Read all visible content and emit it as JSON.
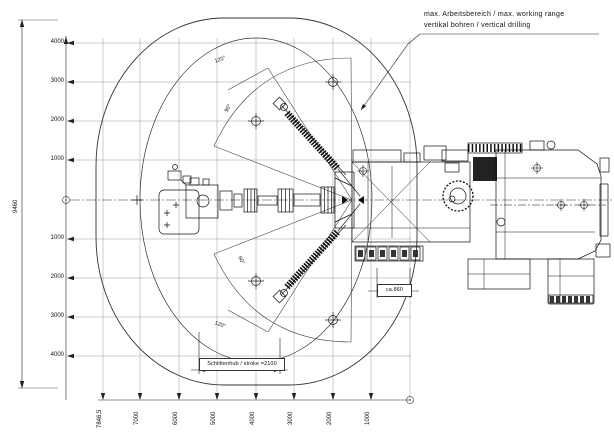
{
  "annotation": {
    "line1": "max. Arbeitsbereich / max. working range",
    "line2": "vertikal bohren / vertical drilling"
  },
  "dimensions": {
    "stroke": "Schlittenhub / stroke =2100",
    "offset": "ca.860",
    "overall_height": "9460"
  },
  "angles": {
    "top": "120°",
    "upper": "90°",
    "lower": "60°",
    "bottom": "120°"
  },
  "left_axis": {
    "ticks": [
      "4000",
      "3000",
      "2000",
      "1000",
      "1000",
      "2000",
      "3000",
      "4000"
    ]
  },
  "bottom_axis": {
    "ticks": [
      "7846,5",
      "7000",
      "6000",
      "5000",
      "4000",
      "3000",
      "2000",
      "1000"
    ]
  },
  "colors": {
    "line": "#1a1a1a",
    "grid": "#8a8a8a",
    "background": "#ffffff"
  }
}
